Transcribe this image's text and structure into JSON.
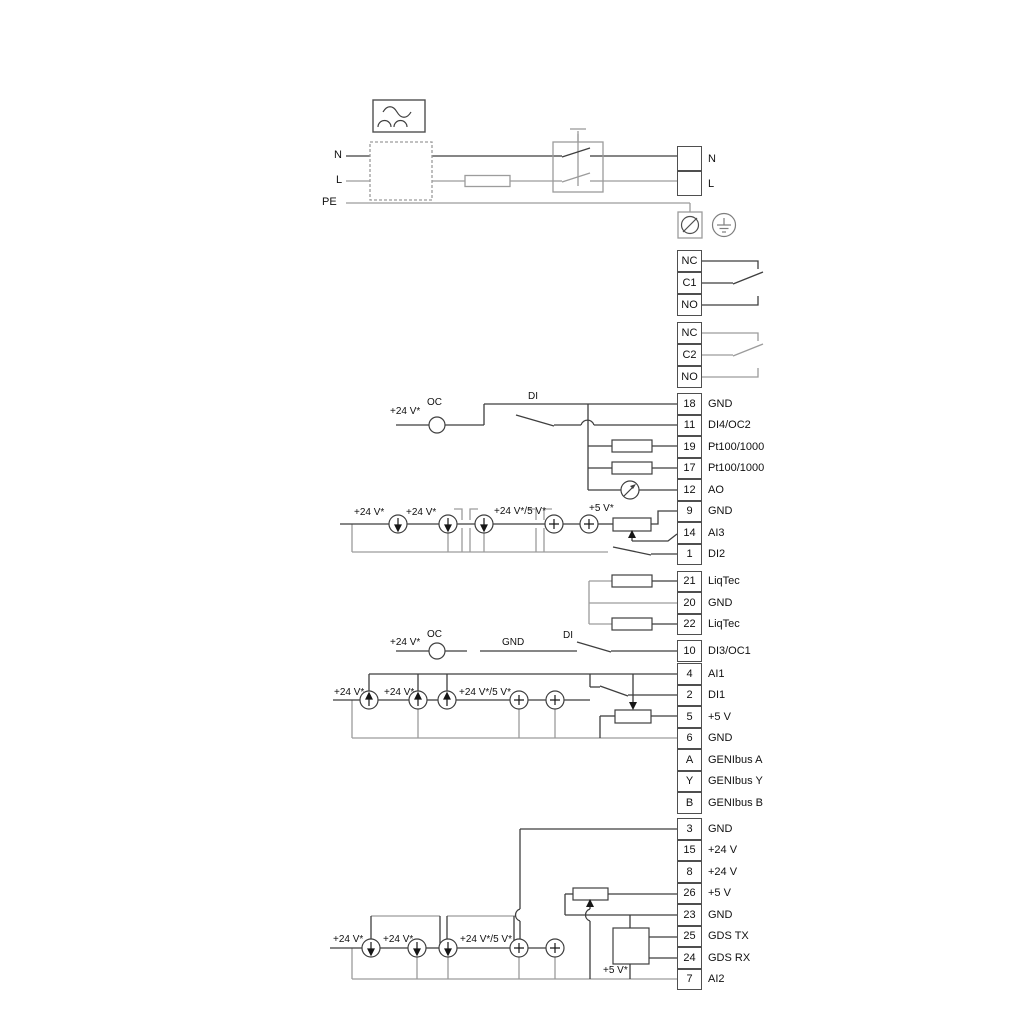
{
  "page": {
    "background": "#ffffff"
  },
  "colors": {
    "wire_dark": "#3f3f3f",
    "wire_gray": "#9c9c9c",
    "text": "#111111"
  },
  "power": {
    "n_label": "N",
    "l_label": "L",
    "pe_label": "PE"
  },
  "strips": [
    {
      "name": "mains-output-terminals",
      "rows": [
        {
          "num": "",
          "label": "N"
        },
        {
          "num": "",
          "label": "L"
        }
      ]
    },
    {
      "name": "relay-1-terminals",
      "rows": [
        {
          "num": "NC",
          "label": ""
        },
        {
          "num": "C1",
          "label": ""
        },
        {
          "num": "NO",
          "label": ""
        }
      ]
    },
    {
      "name": "relay-2-terminals",
      "rows": [
        {
          "num": "NC",
          "label": ""
        },
        {
          "num": "C2",
          "label": ""
        },
        {
          "num": "NO",
          "label": ""
        }
      ]
    },
    {
      "name": "io-terminals-upper",
      "rows": [
        {
          "num": "18",
          "label": "GND"
        },
        {
          "num": "11",
          "label": "DI4/OC2"
        },
        {
          "num": "19",
          "label": "Pt100/1000"
        },
        {
          "num": "17",
          "label": "Pt100/1000"
        },
        {
          "num": "12",
          "label": "AO"
        },
        {
          "num": "9",
          "label": "GND"
        },
        {
          "num": "14",
          "label": "AI3"
        },
        {
          "num": "1",
          "label": "DI2"
        }
      ]
    },
    {
      "name": "liqtec-terminals",
      "rows": [
        {
          "num": "21",
          "label": "LiqTec"
        },
        {
          "num": "20",
          "label": "GND"
        },
        {
          "num": "22",
          "label": "LiqTec"
        }
      ]
    },
    {
      "name": "di3-terminal",
      "rows": [
        {
          "num": "10",
          "label": "DI3/OC1"
        }
      ]
    },
    {
      "name": "io-terminals-middle",
      "rows": [
        {
          "num": "4",
          "label": "AI1"
        },
        {
          "num": "2",
          "label": "DI1"
        },
        {
          "num": "5",
          "label": "+5 V"
        },
        {
          "num": "6",
          "label": "GND"
        },
        {
          "num": "A",
          "label": "GENIbus A"
        },
        {
          "num": "Y",
          "label": "GENIbus Y"
        },
        {
          "num": "B",
          "label": "GENIbus B"
        }
      ]
    },
    {
      "name": "io-terminals-lower",
      "rows": [
        {
          "num": "3",
          "label": "GND"
        },
        {
          "num": "15",
          "label": "+24 V"
        },
        {
          "num": "8",
          "label": "+24 V"
        },
        {
          "num": "26",
          "label": "+5 V"
        },
        {
          "num": "23",
          "label": "GND"
        },
        {
          "num": "25",
          "label": "GDS TX"
        },
        {
          "num": "24",
          "label": "GDS RX"
        },
        {
          "num": "7",
          "label": "AI2"
        }
      ]
    }
  ],
  "annotations": {
    "v24": "+24 V*",
    "v24v5": "+24 V*/5 V*",
    "v5": "+5 V*",
    "oc": "OC",
    "di": "DI",
    "gnd": "GND"
  }
}
